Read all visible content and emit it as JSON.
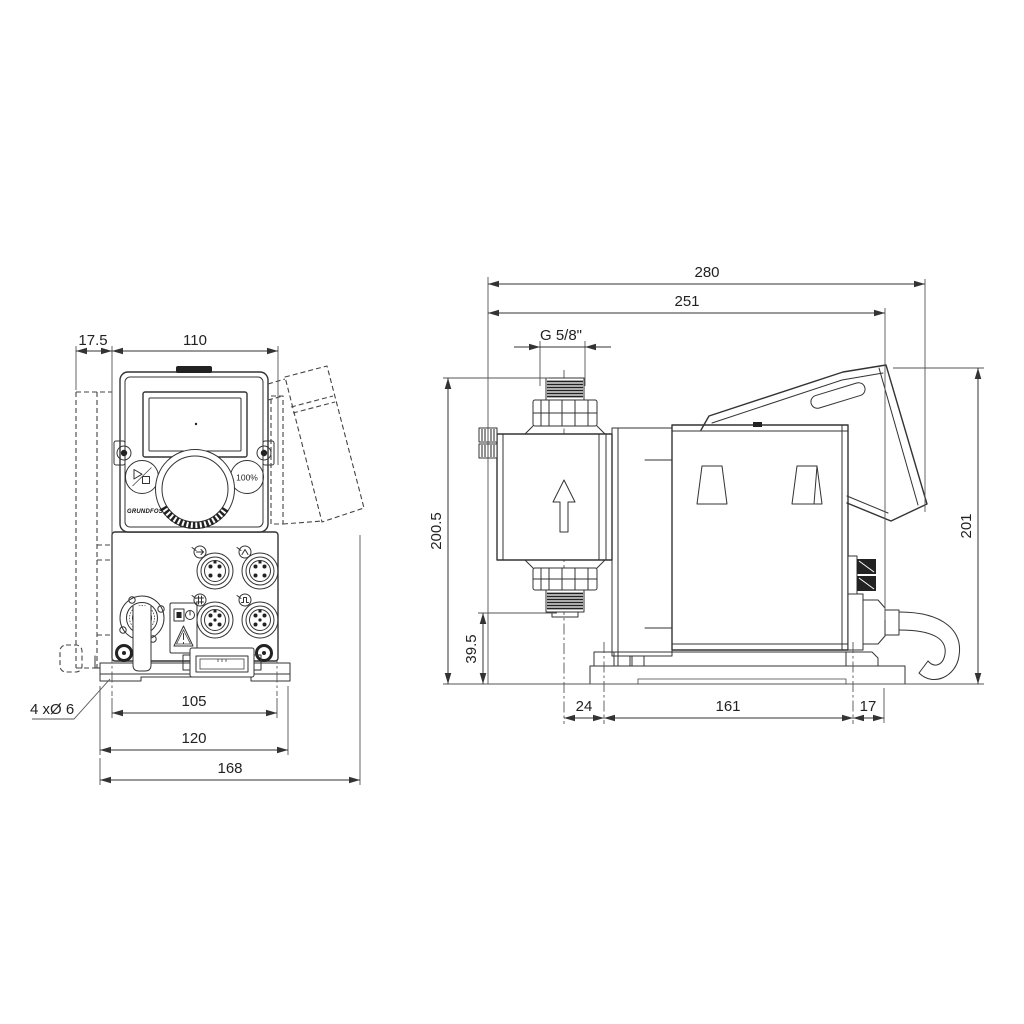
{
  "colors": {
    "line": "#333333",
    "dark": "#222222",
    "text": "#222222",
    "background": "#ffffff"
  },
  "front_view": {
    "dims": {
      "wall_plate_offset": "17.5",
      "control_cube_width": "110",
      "mounting_holes": "4 xØ 6",
      "hole_spacing": "105",
      "foot_plate_width": "120",
      "overall_width": "168"
    },
    "panel": {
      "capacity_button": "100%",
      "logo": "GRUNDFOS"
    }
  },
  "side_view": {
    "dims": {
      "overall_depth": "280",
      "depth_to_hood": "251",
      "connection_thread": "G 5/8\"",
      "overall_height": "200.5",
      "suction_connection_height": "39.5",
      "hood_height": "201",
      "head_center_to_foot": "24",
      "foot_length": "161",
      "foot_to_rear": "17"
    }
  }
}
